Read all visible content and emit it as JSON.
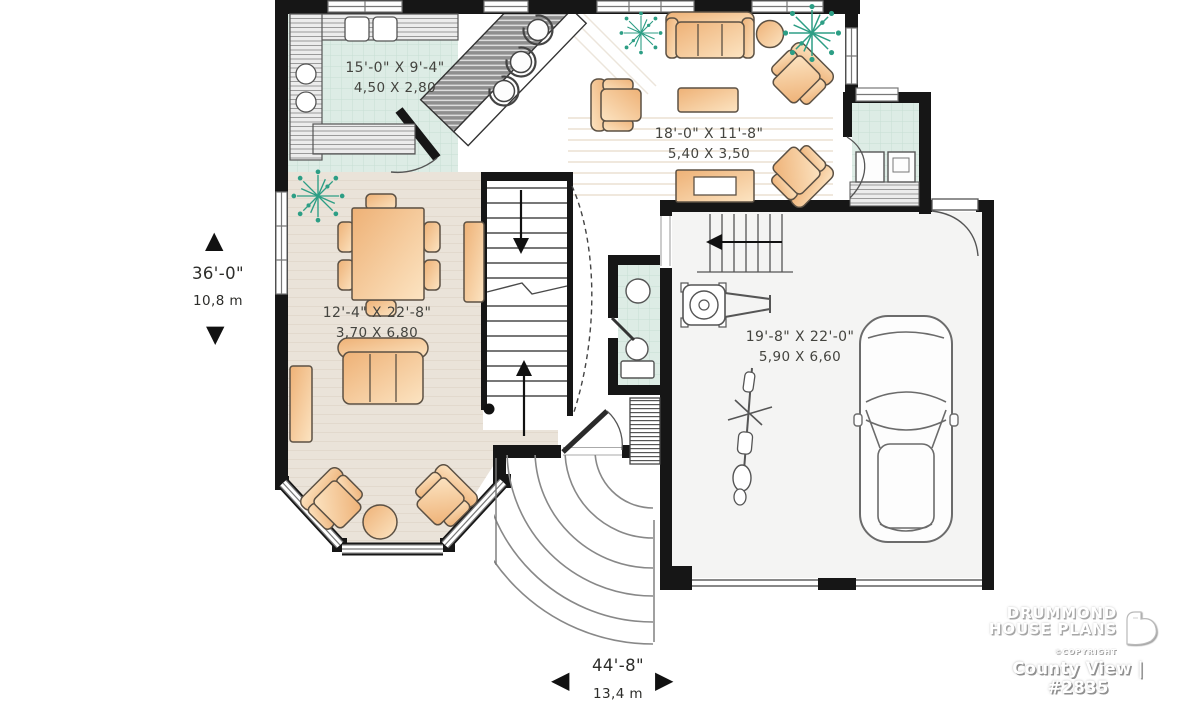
{
  "plan": {
    "rooms": [
      {
        "id": "kitchen",
        "imperial": "15'-0\" X 9'-4\"",
        "metric": "4,50 X 2,80"
      },
      {
        "id": "living-room",
        "imperial": "18'-0\" X 11'-8\"",
        "metric": "5,40 X 3,50"
      },
      {
        "id": "family-room",
        "imperial": "12'-4\" X 22'-8\"",
        "metric": "3,70 X 6,80"
      },
      {
        "id": "garage",
        "imperial": "19'-8\" X 22'-0\"",
        "metric": "5,90 X 6,60"
      }
    ],
    "overall": {
      "depth_imperial": "36'-0\"",
      "depth_metric": "10,8 m",
      "width_imperial": "44'-8\"",
      "width_metric": "13,4 m"
    }
  },
  "branding": {
    "name_line1": "DRUMMOND",
    "name_line2": "HOUSE PLANS",
    "copyright": "©COPYRIGHT",
    "plan_title": "County View | #2835"
  },
  "icons": {
    "arrow_up": "▲",
    "arrow_down": "▼",
    "arrow_left": "◀",
    "arrow_right": "▶"
  },
  "colors": {
    "wall": "#161616",
    "tile_floor": "#ddece5",
    "wood_floor": "#eae3d9",
    "furniture": "#f2bc84",
    "plant": "#2d9e85"
  }
}
